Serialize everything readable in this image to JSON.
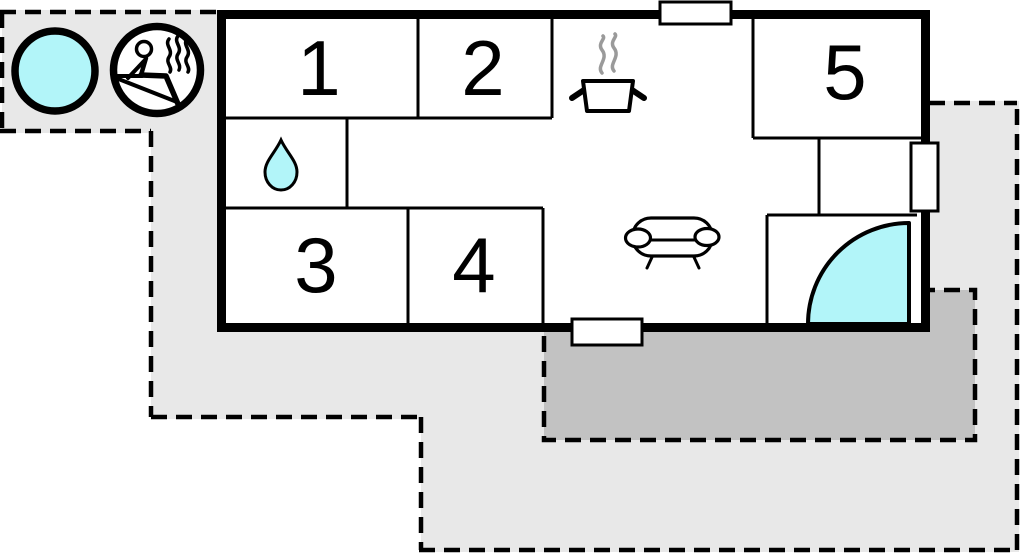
{
  "plan": {
    "type": "floor-plan",
    "rooms": [
      {
        "label": "1"
      },
      {
        "label": "2"
      },
      {
        "label": "3"
      },
      {
        "label": "4"
      },
      {
        "label": "5"
      }
    ],
    "icons": {
      "hot_tub": "hot-tub-circle",
      "sauna": "sauna-person-with-steam",
      "bathroom": "water-drop",
      "kitchen": "steaming-pot",
      "living_room": "sofa",
      "entrance": "door-swing-quarter-circle",
      "windows": [
        "window-top",
        "window-bottom",
        "window-right"
      ]
    },
    "colors": {
      "cyan": "#b2f5f9",
      "light_gray": "#e8e8e8",
      "dark_gray": "#c2c2c2",
      "wall": "#000000",
      "steam_gray": "#9a9a9a",
      "background": "#ffffff"
    }
  }
}
